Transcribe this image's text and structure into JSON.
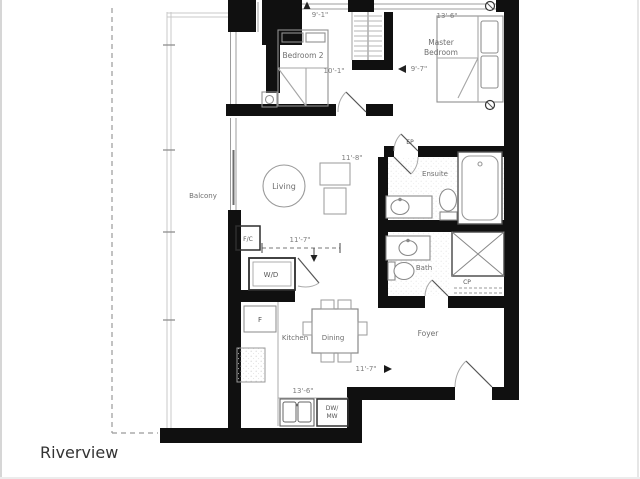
{
  "title": {
    "name": "Riverview"
  },
  "rooms": {
    "balcony": {
      "label": "Balcony"
    },
    "bedroom2": {
      "label": "Bedroom 2",
      "width": "9'-1\"",
      "depth": "10'-1\""
    },
    "master": {
      "label_line1": "Master",
      "label_line2": "Bedroom",
      "width": "13'-6\"",
      "depth": "9'-7\""
    },
    "living": {
      "label": "Living",
      "width": "11'-8\"",
      "depth": "11'-7\""
    },
    "ensuite": {
      "label": "Ensuite"
    },
    "bath": {
      "label": "Bath"
    },
    "foyer": {
      "label": "Foyer",
      "width": "11'-7\""
    },
    "kitchen": {
      "label": "Kitchen",
      "width": "13'-6\""
    },
    "dining": {
      "label": "Dining"
    }
  },
  "fixtures": {
    "washer_dryer": "W/D",
    "fan_coil": "F/C",
    "fridge": "F",
    "dishwasher": "DW/",
    "microwave": "MW",
    "electrical_panel": "EP",
    "closet": "CP"
  },
  "colors": {
    "wall": "#101010",
    "furniture_line": "#8f8f8f",
    "railing": "#c8c8c8",
    "dim_text": "#7d7d7d",
    "label_text": "#6f6f6f",
    "title_text": "#333333"
  }
}
